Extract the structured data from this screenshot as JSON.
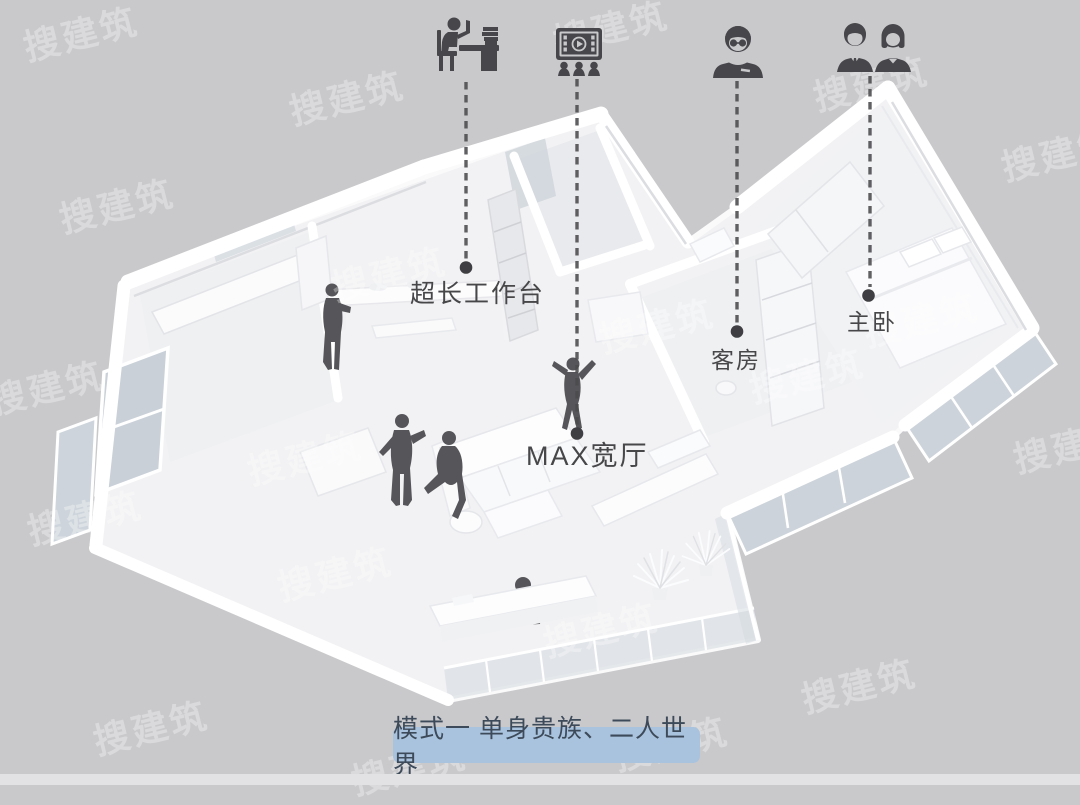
{
  "scene": {
    "type": "3d-floorplan-render",
    "background_color": "#c9c9cc",
    "model_color": "#ffffff",
    "floor_color": "#f2f2f4",
    "glass_color": "#ccd3da",
    "silhouette_color": "#56565a",
    "annotation_color": "#47474b"
  },
  "callouts": [
    {
      "id": "worktable",
      "icon": "person-reading-desk-icon",
      "label": "超长工作台"
    },
    {
      "id": "max-hall",
      "icon": "home-cinema-icon",
      "label": "MAX宽厅"
    },
    {
      "id": "guest-room",
      "icon": "person-glasses-icon",
      "label": "客房"
    },
    {
      "id": "master-bedroom",
      "icon": "couple-icon",
      "label": "主卧"
    }
  ],
  "caption": {
    "text": "模式一  单身贵族、二人世界",
    "background_color": "#a9c3de",
    "text_color": "#3d4a59"
  },
  "watermark": {
    "text": "搜建筑"
  }
}
